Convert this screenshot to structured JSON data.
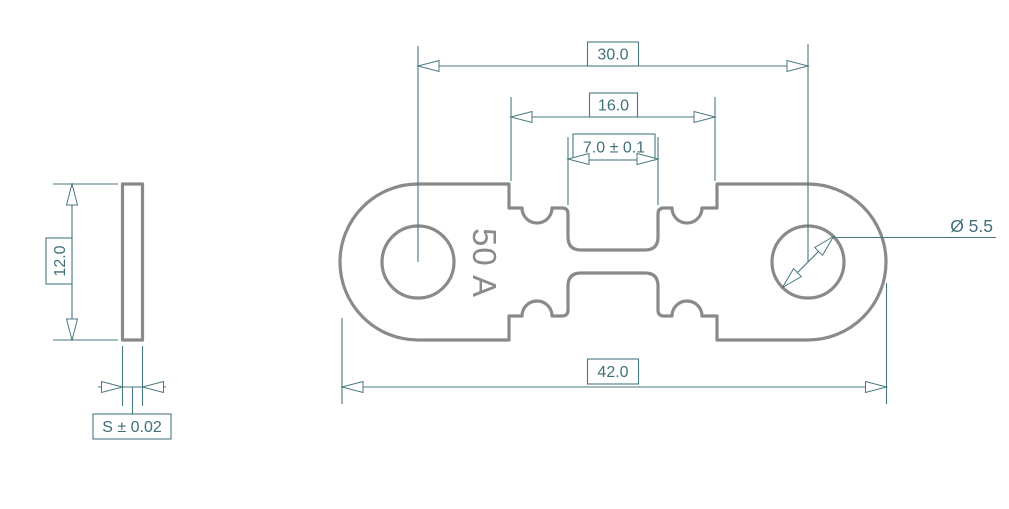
{
  "drawing": {
    "part_rating": "50 A",
    "dimensions": {
      "hole_spacing": "30.0",
      "narrow_width": "16.0",
      "element_width": "7.0 ± 0.1",
      "overall_length": "42.0",
      "hole_diameter": "Ø 5.5",
      "body_height": "12.0",
      "thickness": "S ± 0.02"
    },
    "colors": {
      "outline_gray": "#8a8a8a",
      "dimension_teal": "#497880",
      "text_teal": "#3f7077",
      "background": "#ffffff"
    }
  }
}
